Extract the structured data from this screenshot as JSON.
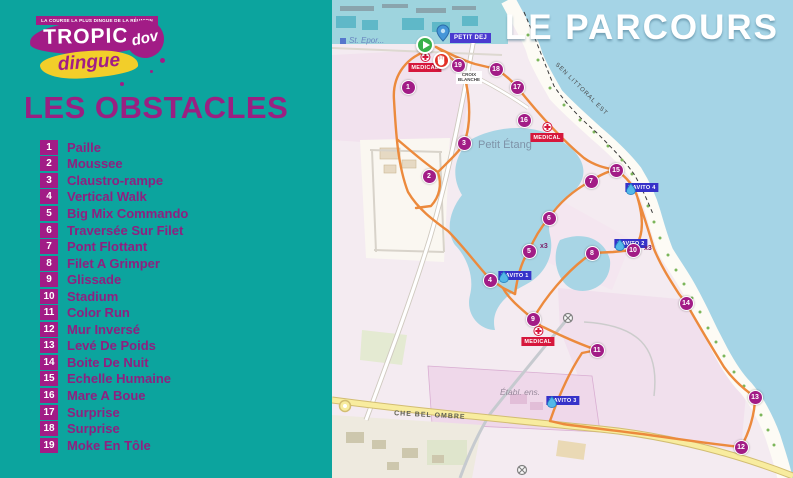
{
  "left_panel": {
    "tagline": "LA COURSE LA PLUS DINGUE DE LA RÉUNION",
    "logo_title": "TROPICA",
    "logo_subtitle": "dingue",
    "logo_badge": "dov",
    "title": "LES OBSTACLES",
    "obstacles": [
      {
        "num": "1",
        "name": "Paille"
      },
      {
        "num": "2",
        "name": "Moussee"
      },
      {
        "num": "3",
        "name": "Claustro-rampe"
      },
      {
        "num": "4",
        "name": "Vertical Walk"
      },
      {
        "num": "5",
        "name": "Big Mix Commando"
      },
      {
        "num": "6",
        "name": "Traversée Sur Filet"
      },
      {
        "num": "7",
        "name": "Pont Flottant"
      },
      {
        "num": "8",
        "name": "Filet A Grimper"
      },
      {
        "num": "9",
        "name": "Glissade"
      },
      {
        "num": "10",
        "name": "Stadium"
      },
      {
        "num": "11",
        "name": "Color Run"
      },
      {
        "num": "12",
        "name": "Mur Inversé"
      },
      {
        "num": "13",
        "name": "Levé De Poids"
      },
      {
        "num": "14",
        "name": "Boite De Nuit"
      },
      {
        "num": "15",
        "name": "Echelle Humaine"
      },
      {
        "num": "16",
        "name": "Mare A Boue"
      },
      {
        "num": "17",
        "name": "Surprise"
      },
      {
        "num": "18",
        "name": "Surprise"
      },
      {
        "num": "19",
        "name": "Moke En Tôle"
      }
    ]
  },
  "map": {
    "title": "LE PARCOURS",
    "badges": {
      "petit_dej": "PETIT DEJ"
    },
    "labels": {
      "st_epor": "St. Epor...",
      "petit_etang": "Petit Étang",
      "croix_blanche_line1": "CROIX",
      "croix_blanche_line2": "BLANCHE",
      "sen_littoral": "SEN LITTORAL EST",
      "che_bel_ombre": "CHE BEL OMBRE",
      "etabl_ens": "Établ. ens."
    },
    "markers": [
      {
        "n": "1",
        "x": 76,
        "y": 87
      },
      {
        "n": "2",
        "x": 97,
        "y": 176
      },
      {
        "n": "3",
        "x": 132,
        "y": 143
      },
      {
        "n": "4",
        "x": 158,
        "y": 280
      },
      {
        "n": "5",
        "x": 197,
        "y": 251
      },
      {
        "n": "6",
        "x": 217,
        "y": 218
      },
      {
        "n": "7",
        "x": 259,
        "y": 181
      },
      {
        "n": "8",
        "x": 260,
        "y": 253
      },
      {
        "n": "9",
        "x": 201,
        "y": 319
      },
      {
        "n": "10",
        "x": 301,
        "y": 250
      },
      {
        "n": "11",
        "x": 265,
        "y": 350
      },
      {
        "n": "12",
        "x": 409,
        "y": 447
      },
      {
        "n": "13",
        "x": 423,
        "y": 397
      },
      {
        "n": "14",
        "x": 354,
        "y": 303
      },
      {
        "n": "15",
        "x": 284,
        "y": 170
      },
      {
        "n": "16",
        "x": 192,
        "y": 120
      },
      {
        "n": "17",
        "x": 185,
        "y": 87
      },
      {
        "n": "18",
        "x": 164,
        "y": 69
      },
      {
        "n": "19",
        "x": 126,
        "y": 65
      }
    ],
    "multipliers": [
      {
        "text": "x3",
        "x": 208,
        "y": 247
      },
      {
        "text": "x3",
        "x": 312,
        "y": 249
      }
    ],
    "ravito": [
      {
        "label": "RAVITO 1",
        "x": 183,
        "y": 285
      },
      {
        "label": "RAVITO 2",
        "x": 299,
        "y": 253
      },
      {
        "label": "RAVITO 3",
        "x": 231,
        "y": 410
      },
      {
        "label": "RAVITO 4",
        "x": 310,
        "y": 197
      }
    ],
    "medical": [
      {
        "label": "MEDICAL",
        "x": 93,
        "y": 52
      },
      {
        "label": "MEDICAL",
        "x": 215,
        "y": 122
      },
      {
        "label": "MEDICAL",
        "x": 206,
        "y": 326
      }
    ]
  },
  "colors": {
    "panel_teal": "#0ca49e",
    "brand_magenta": "#a21c86",
    "text_magenta": "#8e2180",
    "logo_yellow": "#f2ce2a",
    "route_orange": "#ec8a3d",
    "ravito_blue": "#3632c9",
    "medical_red": "#d6173c",
    "sea_blue": "#a5d4e6",
    "land_pink": "#f2e2ee"
  }
}
